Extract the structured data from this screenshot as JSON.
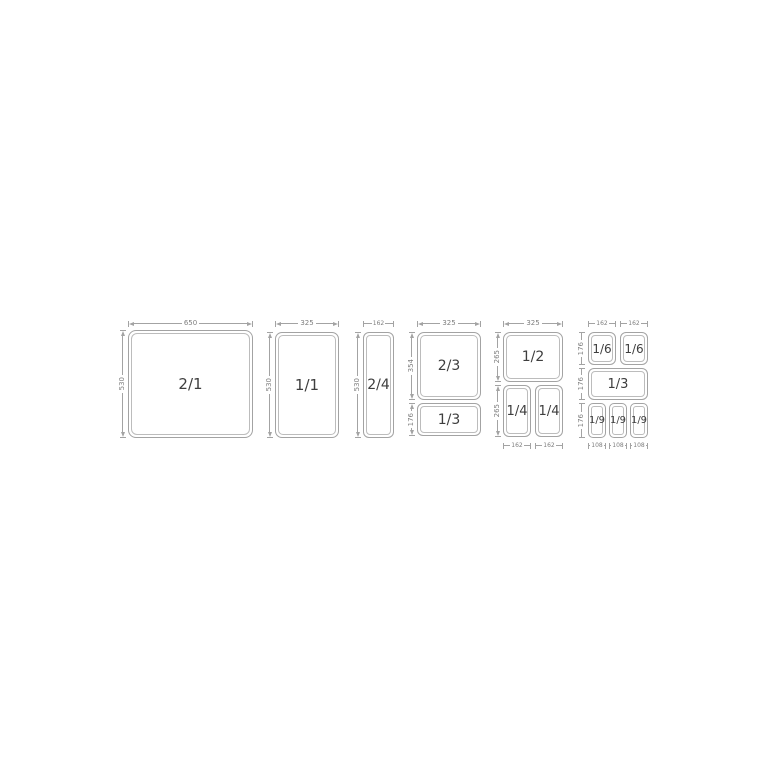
{
  "colors": {
    "background": "#ffffff",
    "line_gray": "#a3a3a3",
    "inner_border_gray": "#bcbcbc",
    "dimension_text": "#7e7e7e",
    "pan_label_text": "#3e3e3e"
  },
  "groups": [
    {
      "top_dims": [
        "650"
      ],
      "left_dims": [
        "530"
      ],
      "bottom_dims": [],
      "pans": [
        "2/1"
      ]
    },
    {
      "top_dims": [
        "325"
      ],
      "left_dims": [
        "530"
      ],
      "bottom_dims": [],
      "pans": [
        "1/1"
      ]
    },
    {
      "top_dims": [
        "162"
      ],
      "left_dims": [
        "530"
      ],
      "bottom_dims": [],
      "pans": [
        "2/4"
      ]
    },
    {
      "top_dims": [
        "325"
      ],
      "left_dims": [
        "354",
        "176"
      ],
      "bottom_dims": [],
      "pans": [
        "2/3",
        "1/3"
      ]
    },
    {
      "top_dims": [
        "325"
      ],
      "left_dims": [
        "265",
        "265"
      ],
      "bottom_dims": [
        "162",
        "162"
      ],
      "pans": [
        "1/2",
        "1/4",
        "1/4"
      ]
    },
    {
      "top_dims": [
        "162",
        "162"
      ],
      "left_dims": [
        "176",
        "176",
        "176"
      ],
      "bottom_dims": [
        "108",
        "108",
        "108"
      ],
      "pans": [
        "1/6",
        "1/6",
        "1/3",
        "1/9",
        "1/9",
        "1/9"
      ]
    }
  ]
}
